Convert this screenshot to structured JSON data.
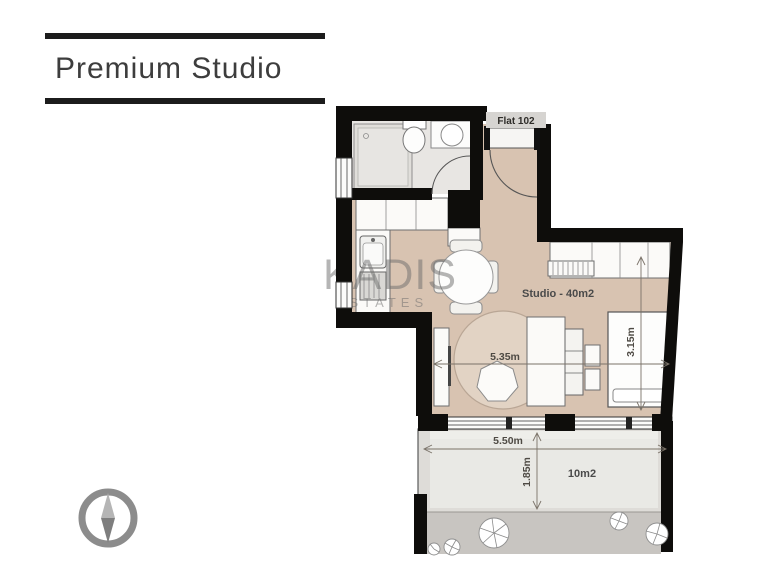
{
  "title": {
    "text": "Premium Studio"
  },
  "watermark": {
    "line1": "KADIS",
    "line2": "ESTATES"
  },
  "plan": {
    "entrance_label": "Flat 102",
    "studio_label": "Studio - 40m2",
    "dim_living_width": "5.35m",
    "dim_bed_depth": "3.15m",
    "dim_balcony_width": "5.50m",
    "dim_balcony_depth": "1.85m",
    "balcony_area": "10m2"
  },
  "colors": {
    "bars": "#1c1c1c",
    "title": "#3d3d3d",
    "wall": "#0e0d0b",
    "floor": "#d8c3b1",
    "bath-floor": "#e8e6e3",
    "balcony-floor": "#dedcd8",
    "balcony-inner": "#e9e9e5",
    "terrace": "#c8c5c1",
    "rug": "#e2d3c4",
    "watermark": "#6d6d6d",
    "dim-text": "#4e4a44",
    "label": "#4a4a4a",
    "compass": "#8c8c8c"
  }
}
